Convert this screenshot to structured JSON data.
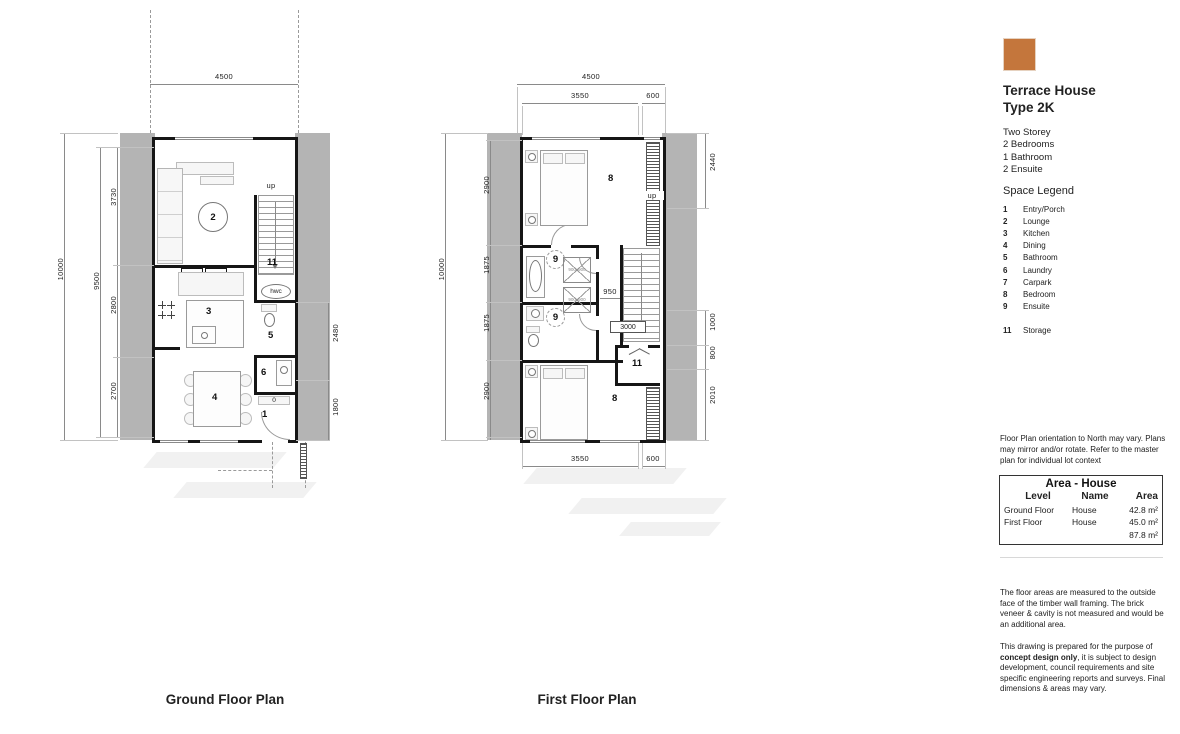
{
  "panel": {
    "swatch_color": "#c4763c",
    "title_line1": "Terrace House",
    "title_line2": "Type 2K",
    "specs": [
      "Two Storey",
      "2 Bedrooms",
      "1 Bathroom",
      "2 Ensuite"
    ],
    "space_legend_heading": "Space Legend",
    "legend": [
      {
        "num": "1",
        "label": "Entry/Porch"
      },
      {
        "num": "2",
        "label": "Lounge"
      },
      {
        "num": "3",
        "label": "Kitchen"
      },
      {
        "num": "4",
        "label": "Dining"
      },
      {
        "num": "5",
        "label": "Bathroom"
      },
      {
        "num": "6",
        "label": "Laundry"
      },
      {
        "num": "7",
        "label": "Carpark"
      },
      {
        "num": "8",
        "label": "Bedroom"
      },
      {
        "num": "9",
        "label": "Ensuite"
      },
      {
        "num": "11",
        "label": "Storage"
      }
    ],
    "orientation_note": "Floor Plan orientation to North may vary. Plans may mirror and/or rotate. Refer to the master plan for individual lot context",
    "area_table": {
      "title": "Area - House",
      "headers": [
        "Level",
        "Name",
        "Area"
      ],
      "rows": [
        [
          "Ground Floor",
          "House",
          "42.8 m²"
        ],
        [
          "First Floor",
          "House",
          "45.0 m²"
        ],
        [
          "",
          "",
          "87.8 m²"
        ]
      ]
    },
    "notes": {
      "p1": "The floor areas are measured to the outside face of the timber wall framing. The brick veneer & cavity is not measured and would be an additional area.",
      "p2_pre": "This drawing is prepared for the purpose of ",
      "p2_bold": "concept design only",
      "p2_post": ", it is subject to design development, council requirements and site specific engineering reports and surveys. Final dimensions & areas may vary."
    }
  },
  "plans": {
    "ground_title": "Ground Floor Plan",
    "first_title": "First Floor Plan"
  },
  "gf": {
    "dims": {
      "top": "4500",
      "outer": "10000",
      "inner": "9500",
      "seg1": "3730",
      "seg2": "2800",
      "seg3": "2700",
      "right1": "2480",
      "right2": "1800"
    },
    "labels": {
      "r1": "1",
      "r2": "2",
      "r3": "3",
      "r4": "4",
      "r5": "5",
      "r6": "6",
      "r11": "11",
      "up": "up",
      "hwc": "hwc",
      "p": "p",
      "fr": "fr",
      "shelf": "0"
    }
  },
  "ff": {
    "dims": {
      "top": "4500",
      "top_a": "3550",
      "top_b": "600",
      "outer": "10000",
      "seg1": "2900",
      "seg2": "1875",
      "seg3": "1875",
      "seg4": "2900",
      "right1": "2440",
      "right2": "1000",
      "right3": "800",
      "right4": "2010",
      "mid": "950",
      "tag": "3000",
      "bottom_a": "3550",
      "bottom_b": "600"
    },
    "labels": {
      "r8a": "8",
      "r8b": "8",
      "r9a": "9",
      "r9b": "9",
      "r11": "11",
      "up": "up",
      "shower_a": "900x900",
      "shower_b": "900x900"
    }
  }
}
